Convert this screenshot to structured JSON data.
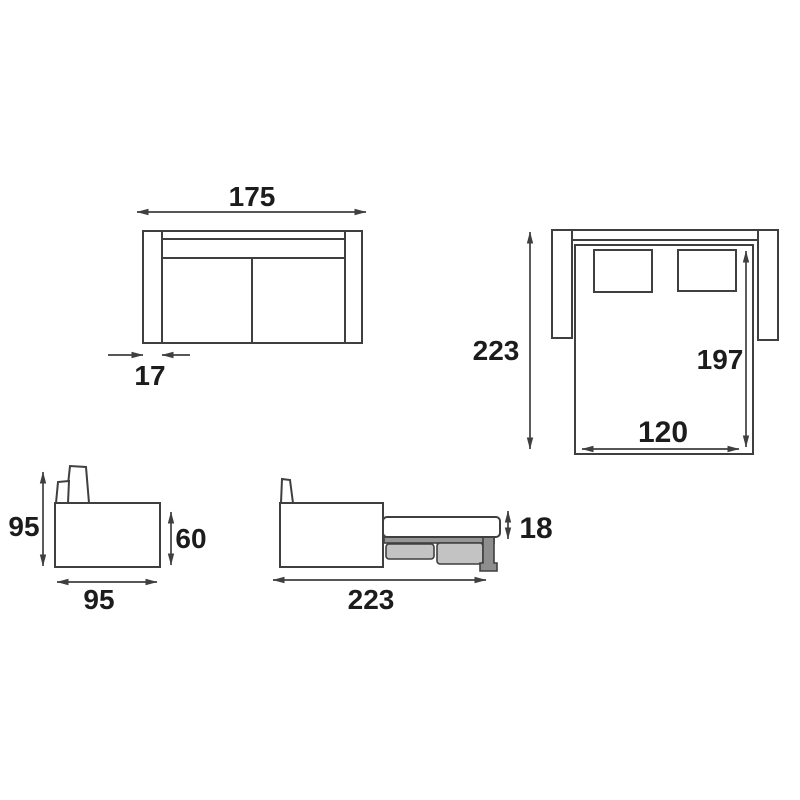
{
  "diagram": {
    "type": "furniture-dimension-drawing",
    "subject": "convertible sofa bed shown closed (front and side views) and opened (top and side views)",
    "units_shown": false,
    "colors": {
      "line": "#3f3f3f",
      "text": "#1c1c1c",
      "background": "#ffffff",
      "drawer_fill": "#c3c3c3",
      "frame_fill": "#969696",
      "leg_fill": "#8e8e8e"
    },
    "views": {
      "front_closed": {
        "overall_width": "175",
        "armrest_width": "17"
      },
      "top_open": {
        "overall_depth": "223",
        "bed_length": "197",
        "bed_width": "120"
      },
      "side_closed": {
        "overall_height": "95",
        "seat_height": "60",
        "depth": "95"
      },
      "side_open": {
        "mattress_thickness": "18",
        "open_depth": "223"
      }
    }
  }
}
